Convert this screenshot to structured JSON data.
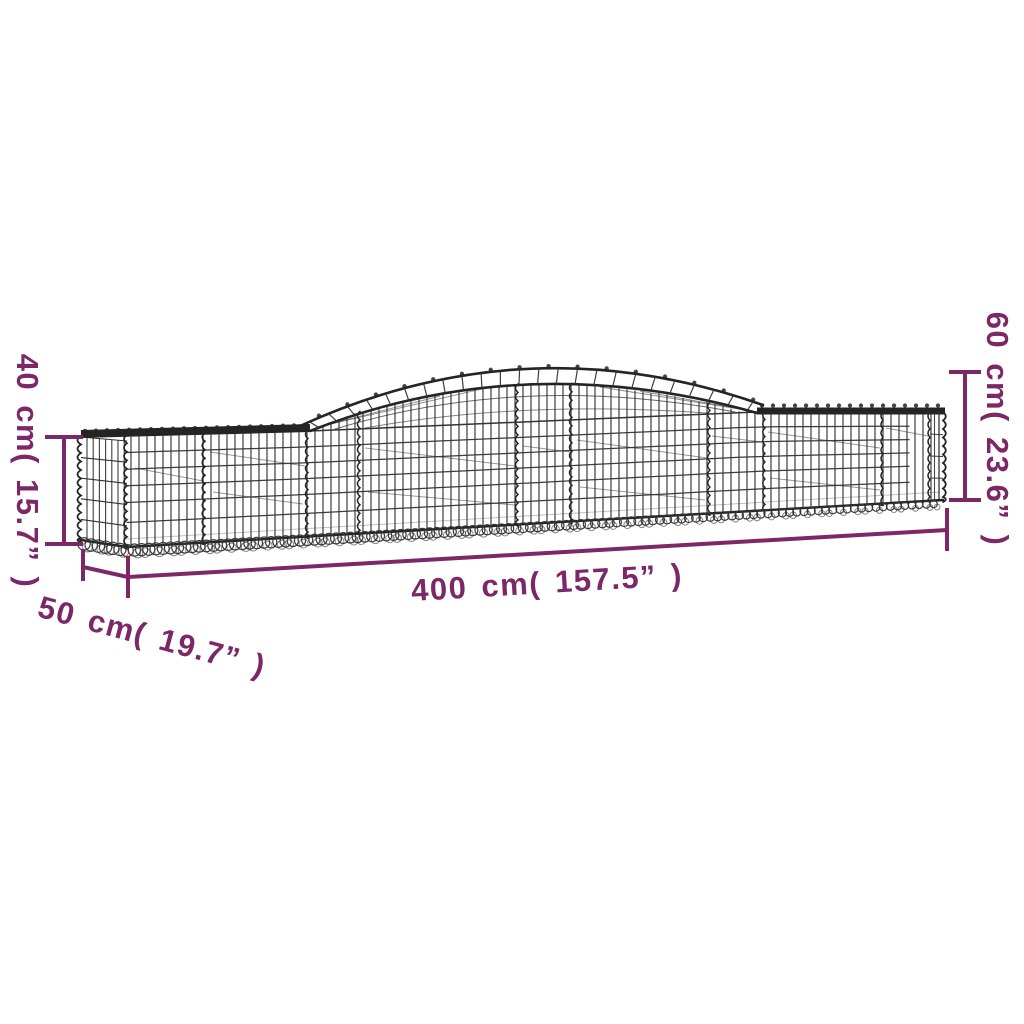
{
  "diagram": {
    "type": "product-dimension-diagram",
    "subject": "arched gabion basket wireframe",
    "background": "#ffffff"
  },
  "colors": {
    "dimension": "#7c2767",
    "mesh": "#333333",
    "mesh_dark": "#242424",
    "mesh_faint": "#6a6a6a"
  },
  "dimensions": {
    "height_left": {
      "cm": "40",
      "inch": "15.7",
      "label": "40 cm( 15.7” )"
    },
    "height_right": {
      "cm": "60",
      "inch": "23.6",
      "label": "60 cm( 23.6” )"
    },
    "length": {
      "cm": "400",
      "inch": "157.5",
      "label": "400 cm( 157.5” )"
    },
    "depth": {
      "cm": "50",
      "inch": "19.7",
      "label": "50 cm( 19.7” )"
    }
  }
}
